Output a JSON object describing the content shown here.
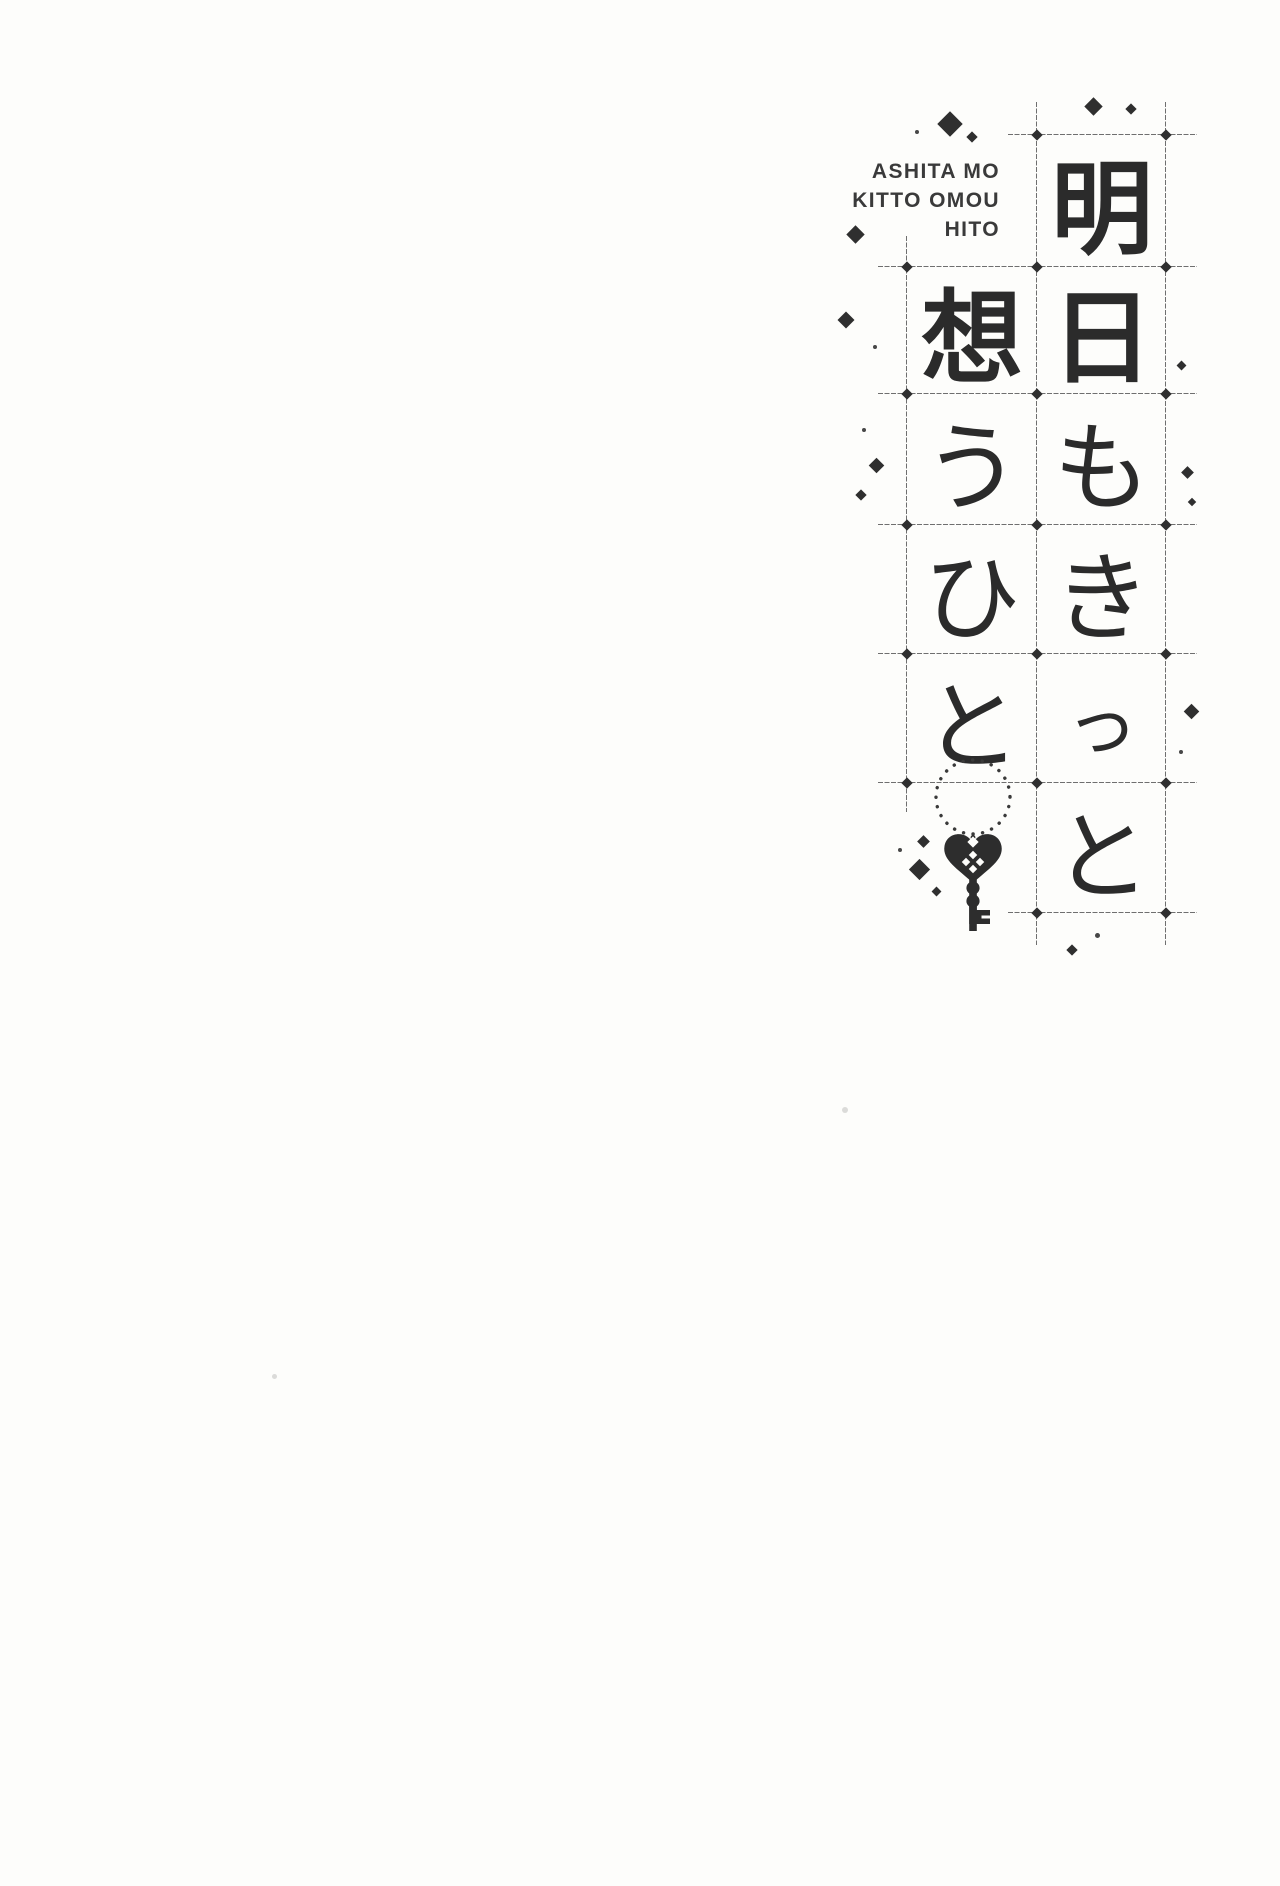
{
  "page": {
    "type": "book title page",
    "background_color": "#fdfdfb",
    "ink_color": "#2b2b2b",
    "grid_line_color": "#6f6f6f"
  },
  "romaji_title": {
    "lines": [
      "ASHITA MO",
      "KITTO OMOU",
      "HITO"
    ]
  },
  "japanese_title": {
    "text": "明日もきっと想うひと",
    "right_column_chars": [
      "明",
      "日",
      "も",
      "き",
      "っ",
      "と"
    ],
    "left_column_chars": [
      "想",
      "う",
      "ひ",
      "と"
    ]
  },
  "ornaments": {
    "key_icon": "heart-key-icon",
    "circle_icon": "dotted-circle-ornament",
    "sparkles_icon": "diamond-sparkle"
  }
}
